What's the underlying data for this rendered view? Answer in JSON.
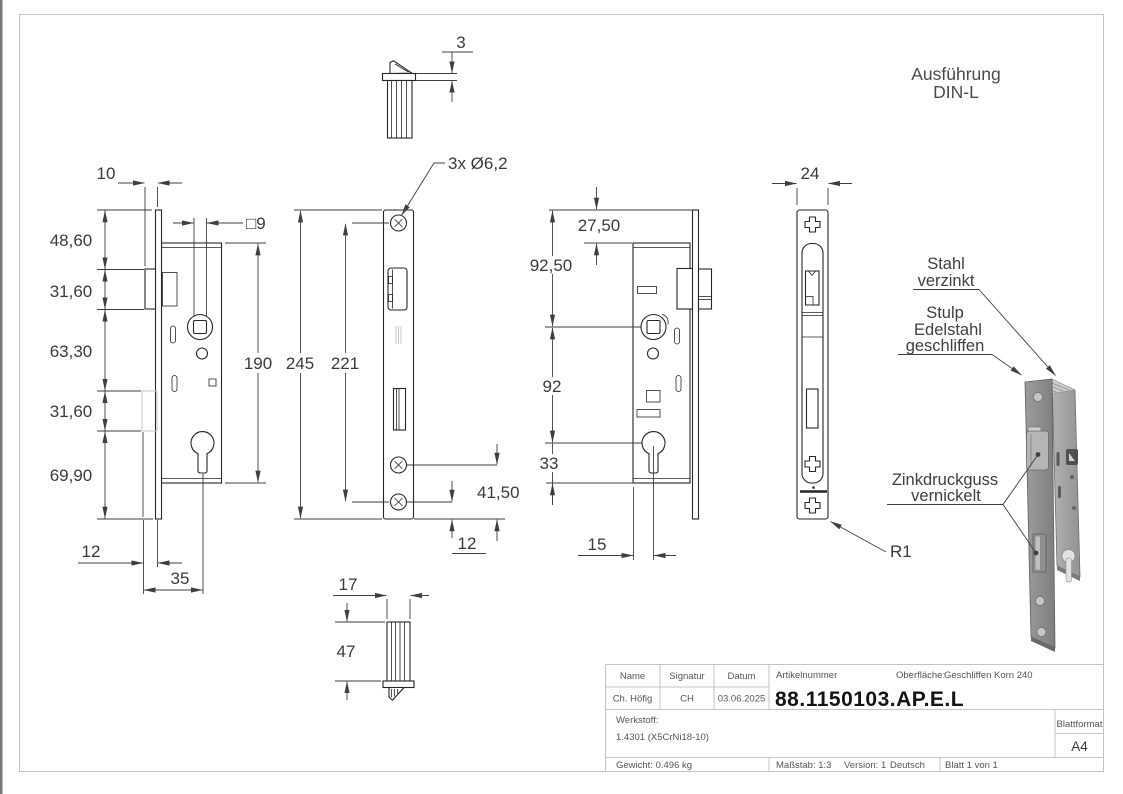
{
  "drawing": {
    "execution": {
      "line1": "Ausführung",
      "line2": "DIN-L"
    },
    "callouts": {
      "stahl_line1": "Stahl",
      "stahl_line2": "verzinkt",
      "stulp_line1": "Stulp",
      "stulp_line2": "Edelstahl",
      "stulp_line3": "geschliffen",
      "zink_line1": "Zinkdruckguss",
      "zink_line2": "vernickelt",
      "radius": "R1",
      "holes": "3x Ø6,2",
      "square": "□9"
    },
    "dims": {
      "d10": "10",
      "d48": "48,60",
      "d31a": "31,60",
      "d63": "63,30",
      "d31b": "31,60",
      "d69": "69,90",
      "d12a": "12",
      "d35": "35",
      "d190": "190",
      "d3": "3",
      "d245": "245",
      "d221": "221",
      "d4150": "41,50",
      "d12b": "12",
      "d17": "17",
      "d47": "47",
      "d2750": "27,50",
      "d9250": "92,50",
      "d92": "92",
      "d33": "33",
      "d15": "15",
      "d24": "24"
    }
  },
  "title_block": {
    "col_name": "Name",
    "col_signatur": "Signatur",
    "col_datum": "Datum",
    "name": "Ch. Höfig",
    "signatur": "CH",
    "datum": "03.06.2025",
    "artikelnummer_label": "Artikelnummer",
    "artikelnummer": "88.1150103.AP.E.L",
    "oberflaeche_label": "Oberfläche:",
    "oberflaeche_value": "Geschliffen Korn 240",
    "werkstoff_label": "Werkstoff:",
    "werkstoff_value": "1.4301 (X5CrNi18-10)",
    "gewicht": "Gewicht: 0.496 kg",
    "massstab": "Maßstab: 1:3",
    "version": "Version: 1",
    "sprache": "Deutsch",
    "blatt": "Blatt 1 von 1",
    "blattformat_label": "Blattformat",
    "blattformat": "A4"
  }
}
